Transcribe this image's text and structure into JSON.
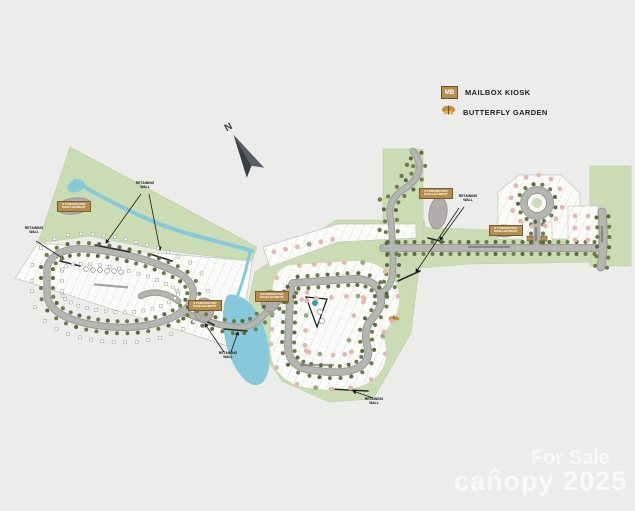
{
  "colors": {
    "bg": "#ececea",
    "green": "#c9dcb4",
    "road": "#b5b6b2",
    "roadCasing": "#97989",
    "roadCasingFull": "#979893",
    "tree": "#6c7c46",
    "treeDark": "#586a3a",
    "pink": "#e7b6ae",
    "lotGreen": "#95ad80",
    "water": "#86c9db",
    "pondGray": "#b3acac",
    "tan": "#b58f4e",
    "tanBorder": "#7c5c2e",
    "teal": "#2f9fb0",
    "wall": "#2b2b2b",
    "arrowDark": "#3a3d41",
    "arrowLight": "#5a5e63"
  },
  "legend": {
    "items": [
      {
        "icon": "mailbox-kiosk",
        "abbr": "MB",
        "label": "MAILBOX KIOSK"
      },
      {
        "icon": "butterfly",
        "label": "BUTTERFLY GARDEN"
      }
    ]
  },
  "compass": {
    "north_label": "N"
  },
  "labels": {
    "stormwater_line1": "STORMWATER",
    "stormwater_line2": "MANAGEMENT",
    "retaining_line1": "RETAINING",
    "retaining_line2": "WALL"
  },
  "watermark": {
    "for_sale": "For Sale",
    "brand": "canopy",
    "year": "2025"
  }
}
